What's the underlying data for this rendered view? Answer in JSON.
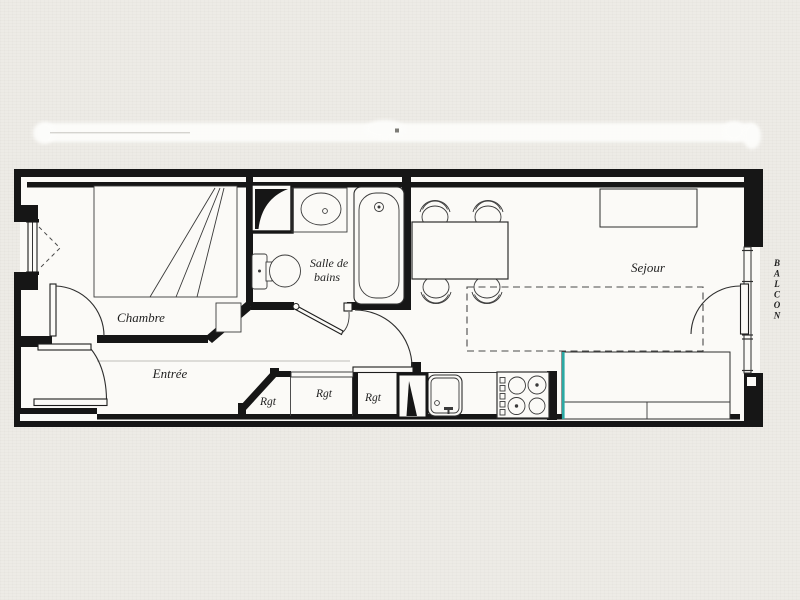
{
  "plan": {
    "rooms": {
      "chambre": "Chambre",
      "entree": "Entrée",
      "bathroom_line1": "Salle de",
      "bathroom_line2": "bains",
      "sejour": "Sejour"
    },
    "storage_labels": [
      "Rgt",
      "Rgt",
      "Rgt"
    ],
    "balcony_letters": [
      "B",
      "A",
      "L",
      "C",
      "O",
      "N"
    ],
    "colors": {
      "accent_teal": "#2ba9a4",
      "ink": "#161616",
      "paper": "#edebe6",
      "interior": "#fbfaf7"
    }
  }
}
